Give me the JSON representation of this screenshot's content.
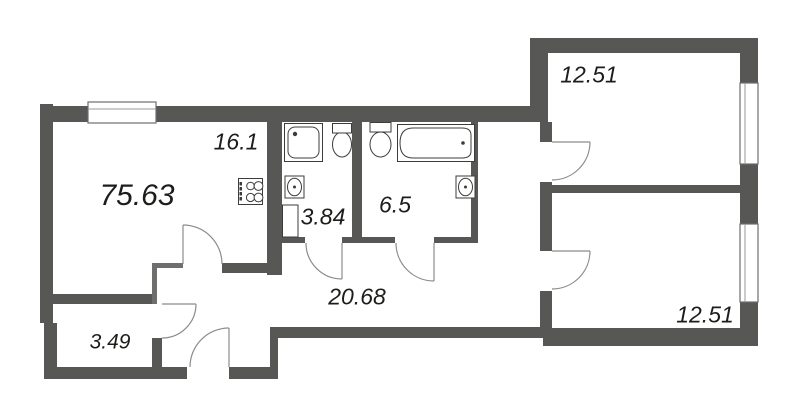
{
  "plan": {
    "type": "apartment-floor-plan",
    "total_area": "75.63",
    "rooms": [
      {
        "key": "living-kitchen",
        "area": "16.1"
      },
      {
        "key": "bathroom-small",
        "area": "3.84"
      },
      {
        "key": "bathroom-large",
        "area": "6.5"
      },
      {
        "key": "hallway",
        "area": "20.68"
      },
      {
        "key": "wardrobe",
        "area": "3.49"
      },
      {
        "key": "bedroom-upper",
        "area": "12.51"
      },
      {
        "key": "bedroom-lower",
        "area": "12.51"
      }
    ],
    "colors": {
      "wall": "#575756",
      "partition": "#6f6f6e",
      "background": "#ffffff",
      "text": "#1d1d1b",
      "fixture_line": "#3c3c3b",
      "door_line": "#8c8c8b"
    }
  }
}
